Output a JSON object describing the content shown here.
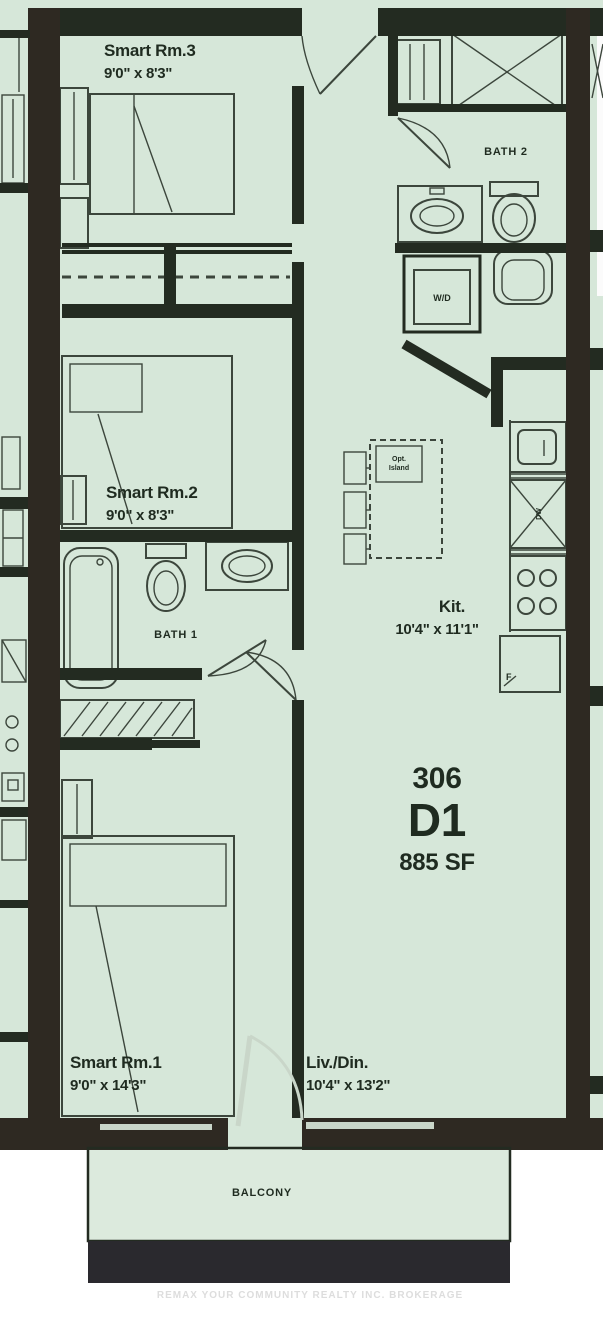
{
  "unit": {
    "number": "306",
    "model": "D1",
    "area": "885 SF"
  },
  "rooms": {
    "smart_rm3": {
      "name": "Smart Rm.3",
      "dims": "9'0\" x 8'3\""
    },
    "smart_rm2": {
      "name": "Smart Rm.2",
      "dims": "9'0\" x 8'3\""
    },
    "smart_rm1": {
      "name": "Smart Rm.1",
      "dims": "9'0\" x 14'3\""
    },
    "liv_din": {
      "name": "Liv./Din.",
      "dims": "10'4\" x 13'2\""
    },
    "kitchen": {
      "name": "Kit.",
      "dims": "10'4\" x 11'1\""
    },
    "bath1": {
      "name": "BATH 1"
    },
    "bath2": {
      "name": "BATH 2"
    },
    "balcony": {
      "name": "BALCONY"
    },
    "laundry": {
      "name": "W/D"
    }
  },
  "fixtures": {
    "dishwasher": "DW",
    "fridge": "F",
    "island_note_line1": "Opt.",
    "island_note_line2": "Island"
  },
  "watermark": "REMAX YOUR COMMUNITY REALTY INC. BROKERAGE",
  "colors": {
    "floor": "#d6e7d9",
    "balcony_floor": "#dceadd",
    "wall": "#232b21",
    "demising": "#2e2922",
    "line": "#3c463c",
    "text": "#1f2b20",
    "balcony_band": "#2a292e",
    "window": "#c9d6c9",
    "watermark": "#dddddd"
  }
}
